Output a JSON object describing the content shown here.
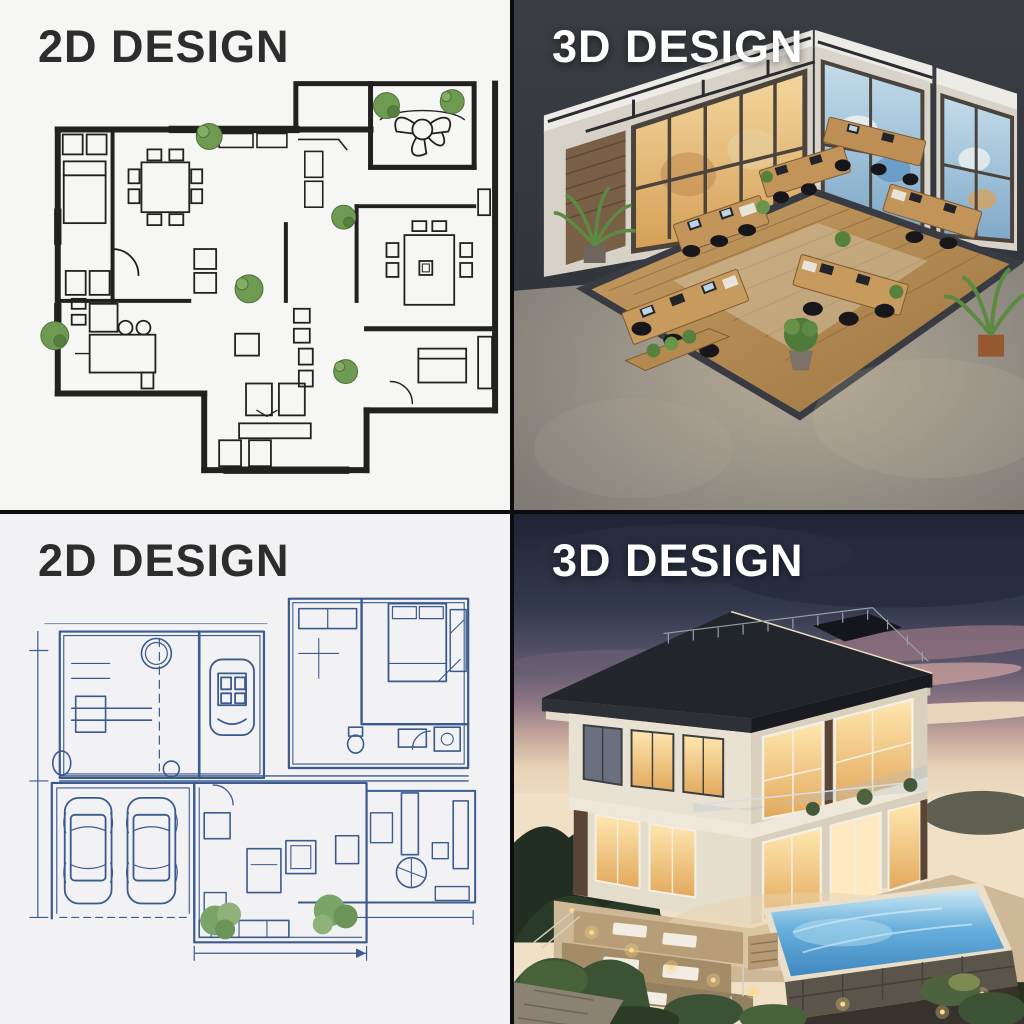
{
  "panels": [
    {
      "position": "top-left",
      "label": "2D DESIGN",
      "content": "hand-drawn architectural floor plan sketch with plants"
    },
    {
      "position": "top-right",
      "label": "3D DESIGN",
      "content": "isometric 3D open-plan office interior render"
    },
    {
      "position": "bottom-left",
      "label": "2D DESIGN",
      "content": "blueprint-style house floor plan with two-car garage"
    },
    {
      "position": "bottom-right",
      "label": "3D DESIGN",
      "content": "3D modern villa exterior render with infinity pool at dusk"
    }
  ],
  "colors": {
    "divider": "#0c0c0e",
    "sketch_paper": "#f6f6f5",
    "sketch_ink": "#22211f",
    "blueprint_paper": "#f2f2f4",
    "blueprint_ink": "#3b5a8e",
    "plant_green": "#5f8a46",
    "office_backdrop": "#34373d",
    "office_concrete": "#8d8880",
    "office_wood": "#b98f55",
    "warm_window_glow": "#eec886",
    "cool_window_blue": "#8fb8d8",
    "dusk_sky_top": "#1f2434",
    "dusk_horizon": "#e7d3b8",
    "pool_blue": "#4f9fd4",
    "title_dark": "#2d2d2d",
    "title_light": "#ffffff"
  }
}
